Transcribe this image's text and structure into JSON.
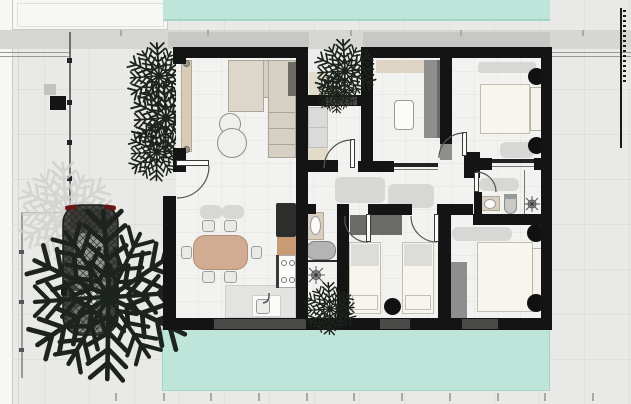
{
  "image": {
    "width": 631,
    "height": 404,
    "kind": "rendered architectural floor plan, top view, no text labels"
  },
  "palette": {
    "ground": "#e9e9e7",
    "margin": "#f7f7f5",
    "marginLine": "#c9c9c7",
    "roofShadow": "#d6d6d4",
    "roofShadowDark": "#c7c7c5",
    "pool": "#bfe5da",
    "poolEdge": "#a5d3c6",
    "wall": "#141414",
    "window": "#4a4a48",
    "floor": "#f2f2f0",
    "courtyard": "#ececea",
    "shadow": "#d2d2d0",
    "sofa": "#d6d0c4",
    "sofaLight": "#ddd7cb",
    "sofaLine": "#aaa49a",
    "table": "#efefed",
    "tableLine": "#8e8e8c",
    "wood": "#d2ab93",
    "woodLine": "#b08f77",
    "chair": "#e9e9e5",
    "chairLine": "#9c9c9a",
    "counter": "#e3e3e1",
    "counterLine": "#cfcfcd",
    "appliance": "#2d2d2b",
    "cabinet": "#c79b73",
    "fixtureWhite": "#fbfbf9",
    "fixtureLine": "#8a8a88",
    "tan": "#d9cfc0",
    "mat": "#e2dbc9",
    "doormat": "#4b4b49",
    "tub": "#b4b4b2",
    "wardrobe": "#8e8e8c",
    "wardrobeDark": "#6b6b69",
    "closet": "#dadad8",
    "bed": "#f7f5ee",
    "bedLine": "#c2beb2",
    "blanket": "#dcdcda",
    "lamp": "#111111",
    "foliage": "#1d231d",
    "foliageShadow": "#cfcfcd",
    "carBody": "#464644",
    "carDark": "#1a1a18",
    "carRoof": "#8c8c8a",
    "carHood": "#6f6f6d",
    "carGlass": "#d8d8d6",
    "carRed": "#6e1616",
    "arc": "#555553",
    "track": "#777775"
  },
  "scene": {
    "type": "2d-floor-plan-render",
    "exterior": {
      "pools": [
        "top-pool",
        "bottom-pool"
      ],
      "vehicle": "car-top-view",
      "vegetation": [
        "large-palm-tree",
        "palm-shadow",
        "hedge-plants",
        "courtyard-palm",
        "indoor-plant"
      ],
      "boundary": [
        "left-margin-strips",
        "fence-line",
        "gate-post",
        "neighbor-wall-dashed",
        "survey-ticks"
      ]
    },
    "rooms": [
      {
        "name": "living-room",
        "objects": [
          "corner-sofa",
          "two-round-coffee-tables",
          "sliding-glass-door",
          "entrance-door"
        ]
      },
      {
        "name": "dining-kitchen",
        "objects": [
          "dining-table",
          "six-chairs",
          "tall-fridge-unit",
          "wood-cabinet",
          "stove-4-burners",
          "counter",
          "island-sink"
        ]
      },
      {
        "name": "entry-courtyard",
        "objects": [
          "palm-tree",
          "rug",
          "doormat"
        ]
      },
      {
        "name": "entry-hall",
        "objects": [
          "closet",
          "rug",
          "interior-door"
        ]
      },
      {
        "name": "utility-room",
        "objects": [
          "shelf-strip",
          "tall-wardrobe",
          "washing-machine",
          "sliding-door"
        ]
      },
      {
        "name": "master-bedroom",
        "objects": [
          "double-bed",
          "two-bedside-lamps",
          "wardrobe-niche",
          "sliding-panel"
        ]
      },
      {
        "name": "ensuite-bathroom",
        "objects": [
          "washbasin",
          "toilet",
          "shower-head",
          "glass-screen"
        ]
      },
      {
        "name": "main-bathroom",
        "objects": [
          "washbasin",
          "bathtub",
          "shower-head",
          "towel-rail"
        ]
      },
      {
        "name": "twin-bedroom",
        "objects": [
          "two-single-beds",
          "wardrobe",
          "bedside-lamp",
          "window"
        ]
      },
      {
        "name": "double-bedroom",
        "objects": [
          "double-bed",
          "wardrobe",
          "two-bedside-lamps",
          "window"
        ]
      }
    ],
    "counts": {
      "bedrooms": 3,
      "bathrooms": 2,
      "pools": 2,
      "palms_dark": 6,
      "door_arcs": 6
    }
  }
}
